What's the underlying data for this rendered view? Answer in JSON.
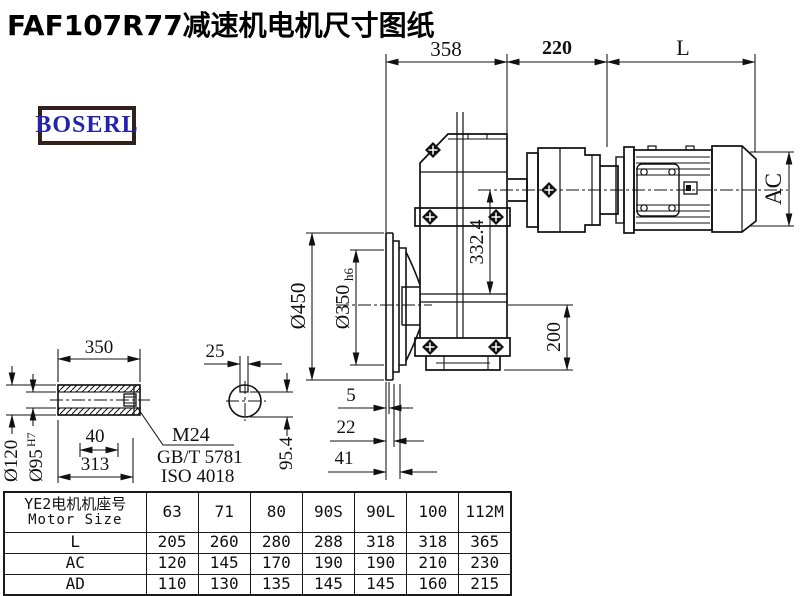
{
  "title": "FAF107R77减速机电机尺寸图纸",
  "logo_text": "BOSERL",
  "drawing": {
    "dim_358": "358",
    "dim_220": "220",
    "dim_L": "L",
    "dim_AC": "AC",
    "dim_332_4": "332.4",
    "dim_450": "Ø450",
    "dim_350": "Ø350",
    "dim_350_tol": "h6",
    "dim_200": "200",
    "dim_5": "5",
    "dim_22": "22",
    "dim_41": "41"
  },
  "shaft_detail": {
    "dim_350": "350",
    "dim_25": "25",
    "dim_120": "Ø120",
    "dim_95": "Ø95",
    "dim_95_tol": "H7",
    "dim_40": "40",
    "dim_313": "313",
    "dim_95_4": "95.4",
    "thread_label": "M24",
    "standard_1": "GB/T 5781",
    "standard_2": "ISO 4018"
  },
  "table": {
    "header_line1": "YE2电机机座号",
    "header_line2": "Motor Size",
    "motor_sizes": [
      "63",
      "71",
      "80",
      "90S",
      "90L",
      "100",
      "112M"
    ],
    "rows": [
      {
        "label": "L",
        "values": [
          "205",
          "260",
          "280",
          "288",
          "318",
          "318",
          "365"
        ]
      },
      {
        "label": "AC",
        "values": [
          "120",
          "145",
          "170",
          "190",
          "190",
          "210",
          "230"
        ]
      },
      {
        "label": "AD",
        "values": [
          "110",
          "130",
          "135",
          "145",
          "145",
          "160",
          "215"
        ]
      }
    ]
  }
}
